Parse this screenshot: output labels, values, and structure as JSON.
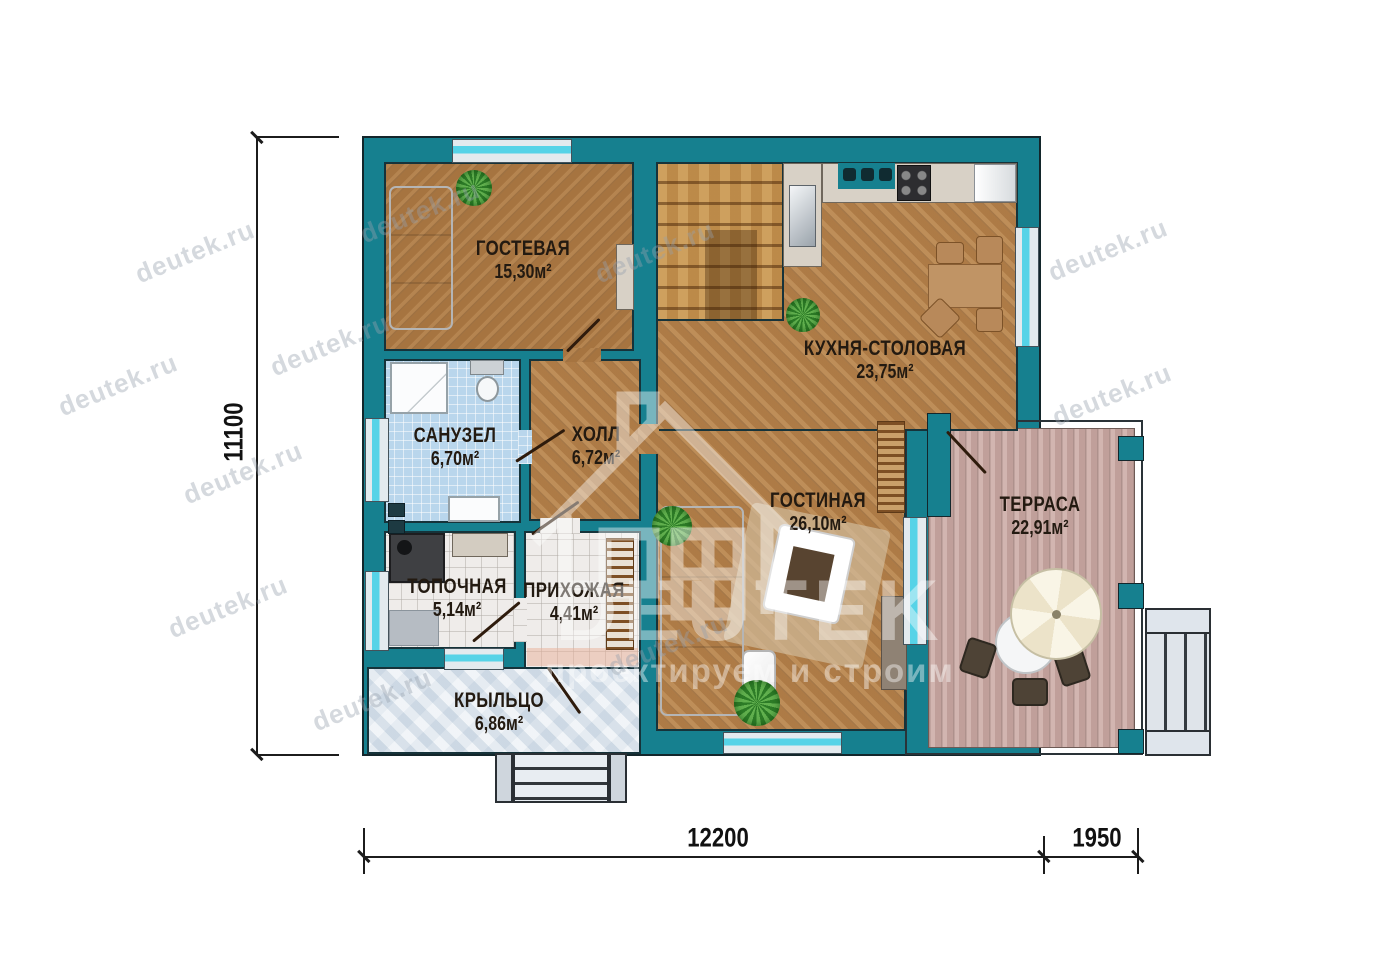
{
  "plan_title": "Floor plan — first floor",
  "rooms": {
    "guest": {
      "name": "ГОСТЕВАЯ",
      "area": "15,30м²"
    },
    "kitchen": {
      "name": "КУХНЯ-СТОЛОВАЯ",
      "area": "23,75м²"
    },
    "bathroom": {
      "name": "САНУЗЕЛ",
      "area": "6,70м²"
    },
    "hall": {
      "name": "ХОЛЛ",
      "area": "6,72м²"
    },
    "living": {
      "name": "ГОСТИНАЯ",
      "area": "26,10м²"
    },
    "terrace": {
      "name": "ТЕРРАСА",
      "area": "22,91м²"
    },
    "boiler": {
      "name": "ТОПОЧНАЯ",
      "area": "5,14м²"
    },
    "entry": {
      "name": "ПРИХОЖАЯ",
      "area": "4,41м²"
    },
    "porch": {
      "name": "КРЫЛЬЦО",
      "area": "6,86м²"
    }
  },
  "dimensions": {
    "height_total": "11100",
    "width_main": "12200",
    "width_terrace": "1950"
  },
  "watermark": {
    "text": "deutek.ru"
  },
  "logo": {
    "brand": "DEUTEK",
    "tagline": "проектируем и строим"
  },
  "colors": {
    "wall_teal": "#16808f",
    "window_glass": "#56d3e7",
    "wood_floor": "#b5824c",
    "terrace_floor": "#c8a9a4",
    "bathroom_tile": "#b9d6ec"
  }
}
